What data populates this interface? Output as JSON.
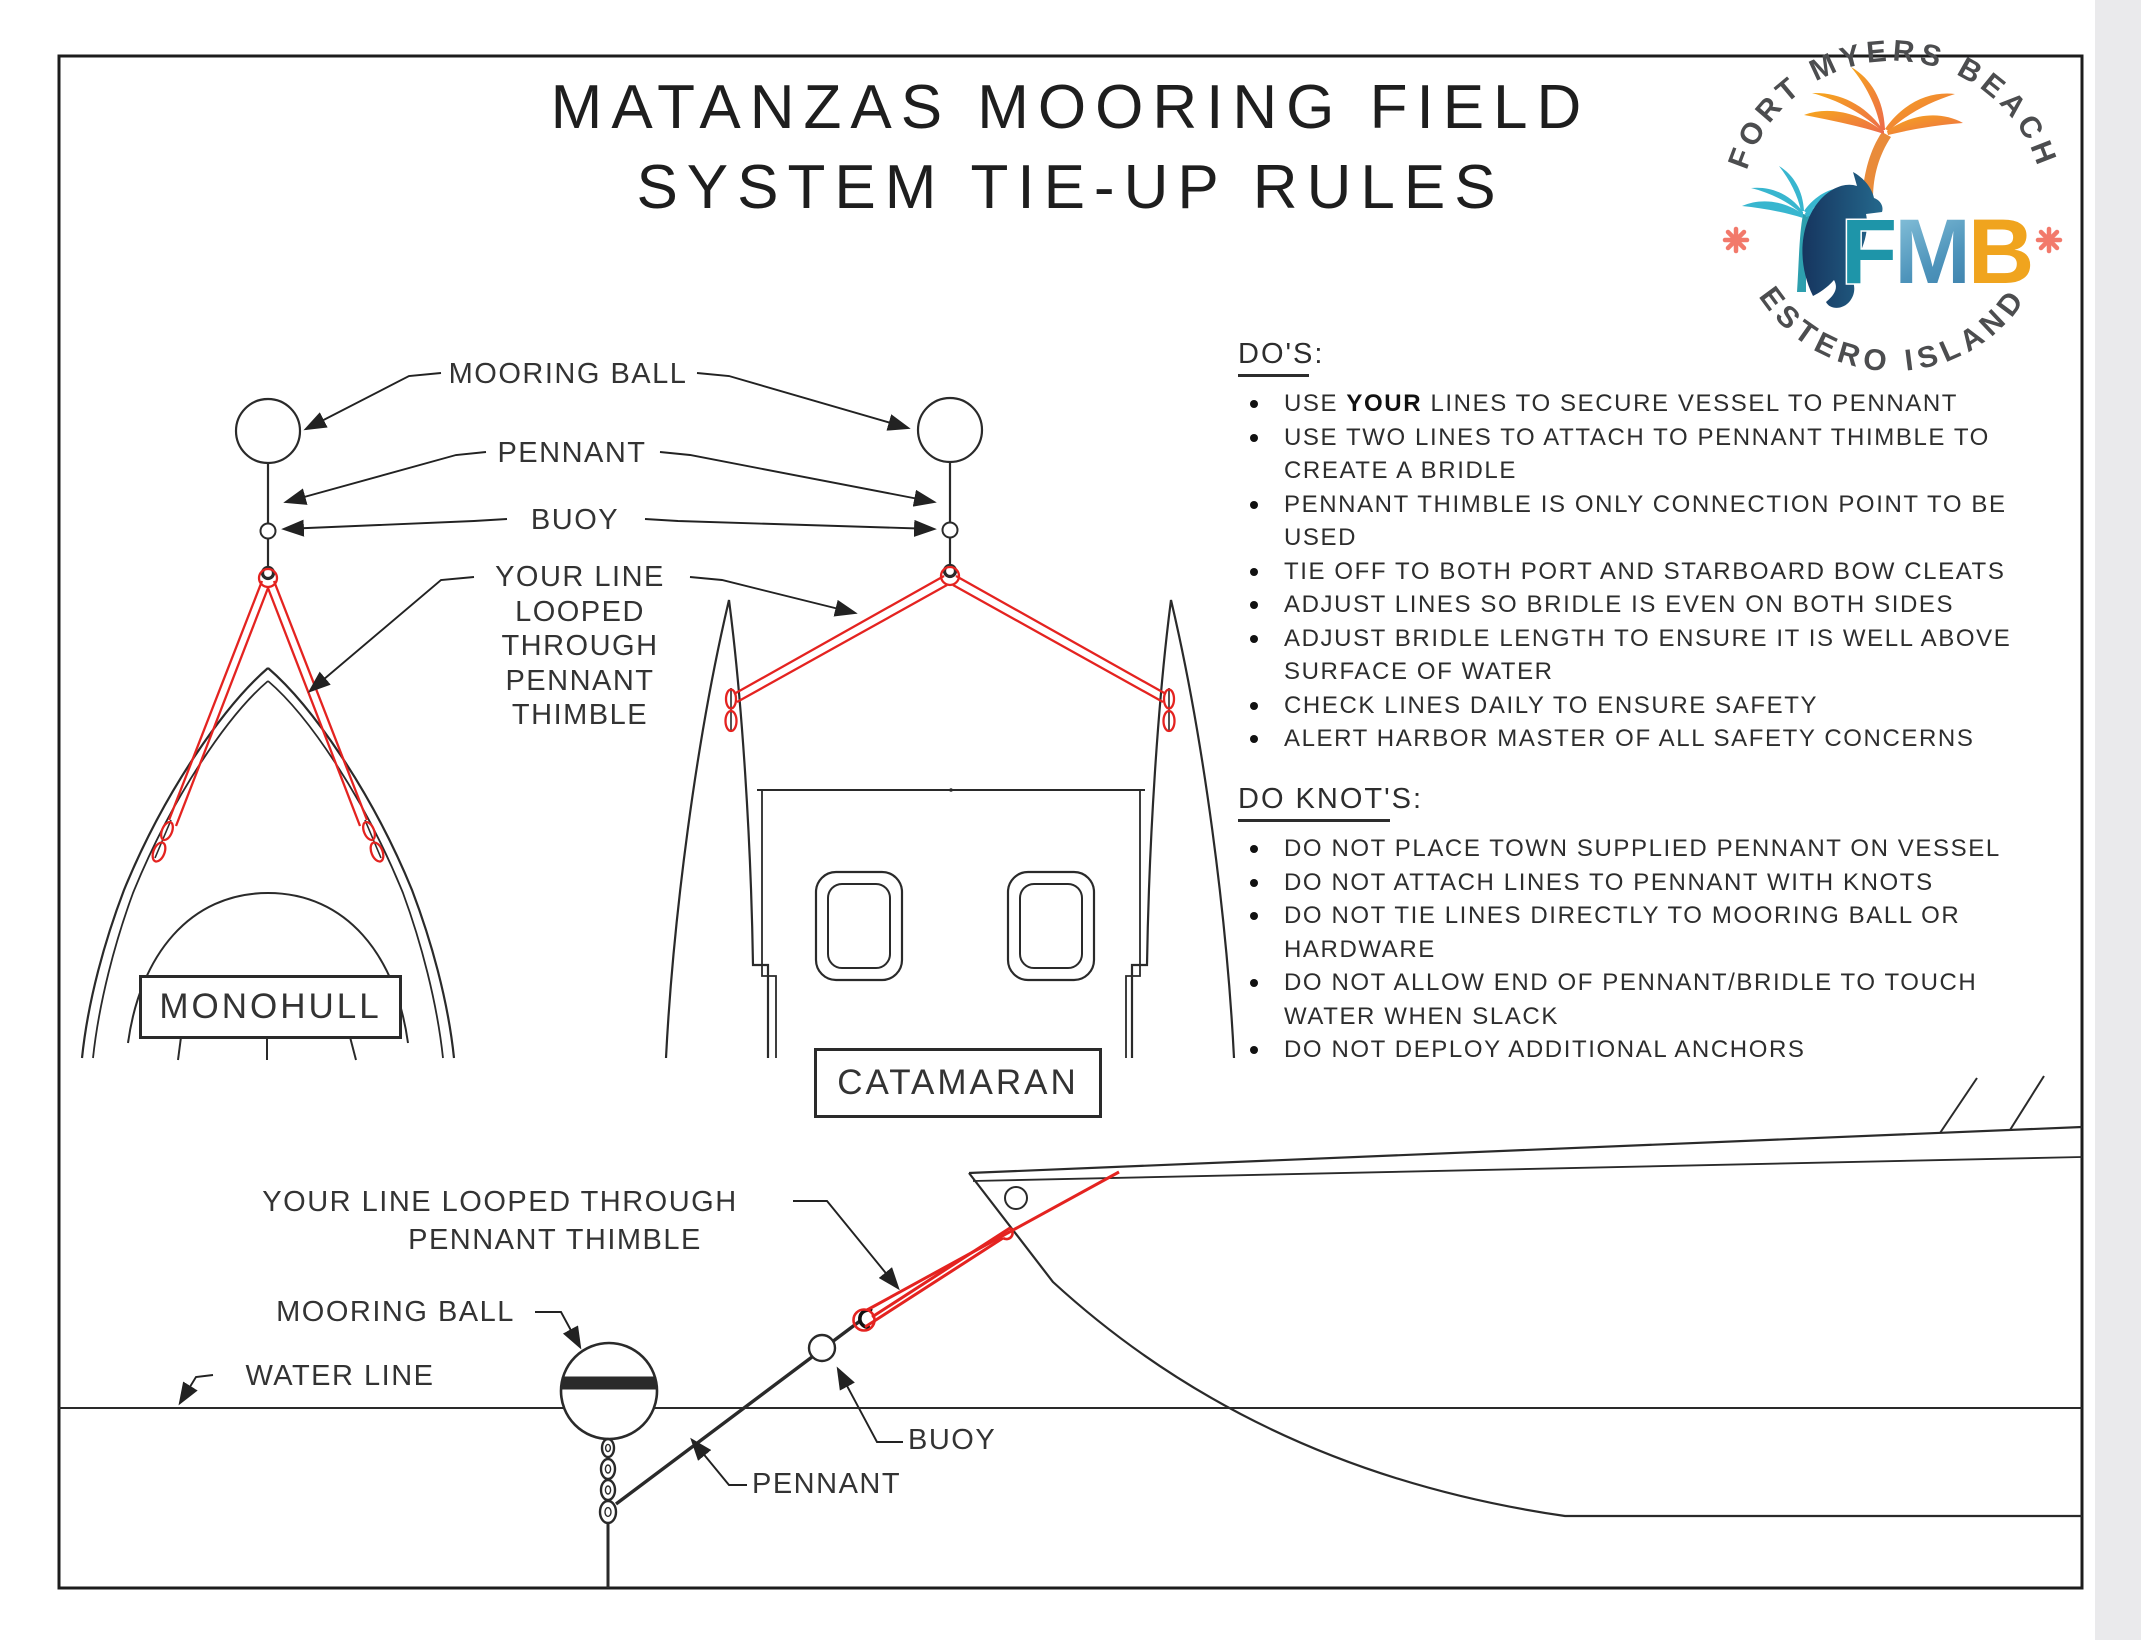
{
  "title": {
    "line1": "MATANZAS MOORING FIELD",
    "line2": "SYSTEM TIE-UP RULES"
  },
  "logo": {
    "arc_top": "FORT MYERS BEACH",
    "arc_bottom": "ESTERO ISLAND",
    "monogram_f": "F",
    "monogram_m": "M",
    "monogram_b": "B"
  },
  "diagram_labels": {
    "mooring_ball": "MOORING BALL",
    "pennant": "PENNANT",
    "buoy": "BUOY",
    "your_line_lines": [
      "YOUR LINE",
      "LOOPED",
      "THROUGH",
      "PENNANT",
      "THIMBLE"
    ],
    "monohull": "MONOHULL",
    "catamaran": "CATAMARAN"
  },
  "dos": {
    "heading": "DO'S:",
    "items": [
      {
        "lines": [
          "USE **YOUR** LINES TO SECURE VESSEL TO PENNANT"
        ]
      },
      {
        "lines": [
          "USE TWO LINES TO ATTACH TO PENNANT THIMBLE TO",
          "CREATE A BRIDLE"
        ]
      },
      {
        "lines": [
          "PENNANT THIMBLE IS ONLY CONNECTION POINT TO BE",
          "USED"
        ]
      },
      {
        "lines": [
          "TIE OFF TO BOTH PORT AND STARBOARD BOW CLEATS"
        ]
      },
      {
        "lines": [
          "ADJUST LINES SO BRIDLE IS EVEN ON BOTH SIDES"
        ]
      },
      {
        "lines": [
          "ADJUST BRIDLE LENGTH TO ENSURE IT IS WELL ABOVE",
          "SURFACE OF WATER"
        ]
      },
      {
        "lines": [
          "CHECK LINES DAILY TO ENSURE SAFETY"
        ]
      },
      {
        "lines": [
          "ALERT HARBOR MASTER OF ALL SAFETY CONCERNS"
        ]
      }
    ]
  },
  "do_knots": {
    "heading": "DO KNOT'S:",
    "items": [
      {
        "lines": [
          "DO NOT PLACE TOWN SUPPLIED PENNANT ON VESSEL"
        ]
      },
      {
        "lines": [
          "DO NOT ATTACH LINES TO PENNANT WITH KNOTS"
        ]
      },
      {
        "lines": [
          "DO NOT TIE LINES DIRECTLY TO MOORING BALL OR",
          "HARDWARE"
        ]
      },
      {
        "lines": [
          "DO NOT ALLOW END OF PENNANT/BRIDLE TO TOUCH",
          "WATER WHEN SLACK"
        ]
      },
      {
        "lines": [
          "DO NOT DEPLOY ADDITIONAL ANCHORS"
        ]
      }
    ]
  },
  "side_view_labels": {
    "your_line_line1": "YOUR LINE LOOPED THROUGH",
    "your_line_line2": "PENNANT THIMBLE",
    "mooring_ball": "MOORING BALL",
    "water_line": "WATER LINE",
    "buoy": "BUOY",
    "pennant": "PENNANT"
  },
  "colors": {
    "line_red": "#e42320",
    "ink": "#2a2a2a",
    "logo_teal": "#1e95a9",
    "logo_navy": "#16355f",
    "logo_gold": "#f0a41e",
    "logo_coral": "#f2796b",
    "logo_gray": "#4c4d4f",
    "palm_orange": "#f6a71c",
    "palm_teal": "#38b6cf"
  }
}
